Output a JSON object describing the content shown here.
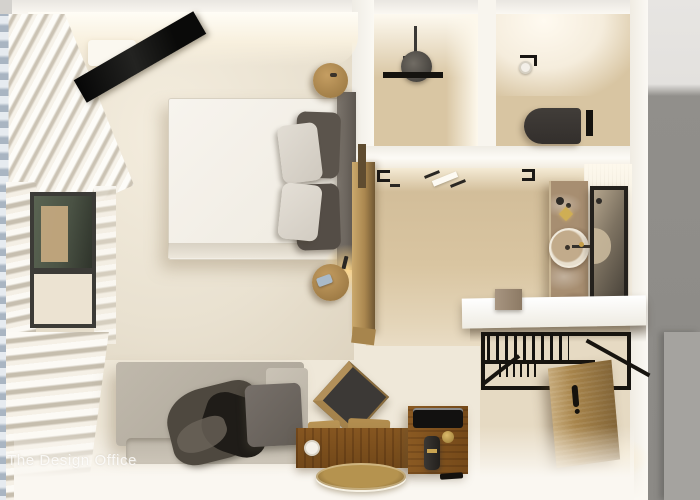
{
  "watermark": {
    "text": "The Design Office"
  },
  "scene": {
    "type": "3d-interior-render-top-view",
    "subject": "hotel studio room floor plan render",
    "rooms": [
      {
        "name": "bedroom",
        "items": [
          "double-bed",
          "duvet",
          "dark-pillows",
          "light-pillows",
          "headboard",
          "wall-mounted-tv",
          "round-nightstand-top",
          "round-nightstand-bottom",
          "table-lamp",
          "phone-on-nightstand",
          "sheer-curtains",
          "window",
          "wood-partition"
        ]
      },
      {
        "name": "shower-room",
        "items": [
          "rain-shower-head",
          "shower-pole",
          "shower-niche-bar"
        ]
      },
      {
        "name": "toilet-room",
        "items": [
          "wall-hung-toilet",
          "toilet-paper-holder",
          "flush-plate"
        ]
      },
      {
        "name": "vanity-area",
        "items": [
          "marble-vanity-slab",
          "round-basin",
          "faucet",
          "gold-soap-dish",
          "framed-mirror",
          "fluted-wall"
        ]
      },
      {
        "name": "entry",
        "items": [
          "white-counter-shelf",
          "marble-block",
          "open-wardrobe-rack",
          "clothes-hangers",
          "entry-door",
          "door-handle"
        ]
      },
      {
        "name": "living-area",
        "items": [
          "sofa",
          "seat-cushion",
          "throw-blanket",
          "wood-chair",
          "wood-bench-desk",
          "paper-roll",
          "minibar-cube",
          "black-tray",
          "kettle",
          "gold-knob",
          "remote",
          "round-bronze-rug"
        ]
      }
    ],
    "palette": {
      "floor_cream": "#efe8d9",
      "floor_beige": "#e9e1d0",
      "floor_tan": "#d7c3a0",
      "wall_white": "#f9f6f0",
      "wood": "#ab874f",
      "marble": "#a78e71",
      "black_metal": "#17140f",
      "sofa_gray": "#b6afa2",
      "dark_gray": "#56504a",
      "outside_gray": "#908e8a",
      "outside_light": "#e7e5e2",
      "window_blue_gray": "#b9c3cd",
      "accent_gold": "#c9a24b",
      "lamp_glow": "#ffd98c",
      "watermark_white": "rgba(255,255,255,0.8)"
    }
  }
}
